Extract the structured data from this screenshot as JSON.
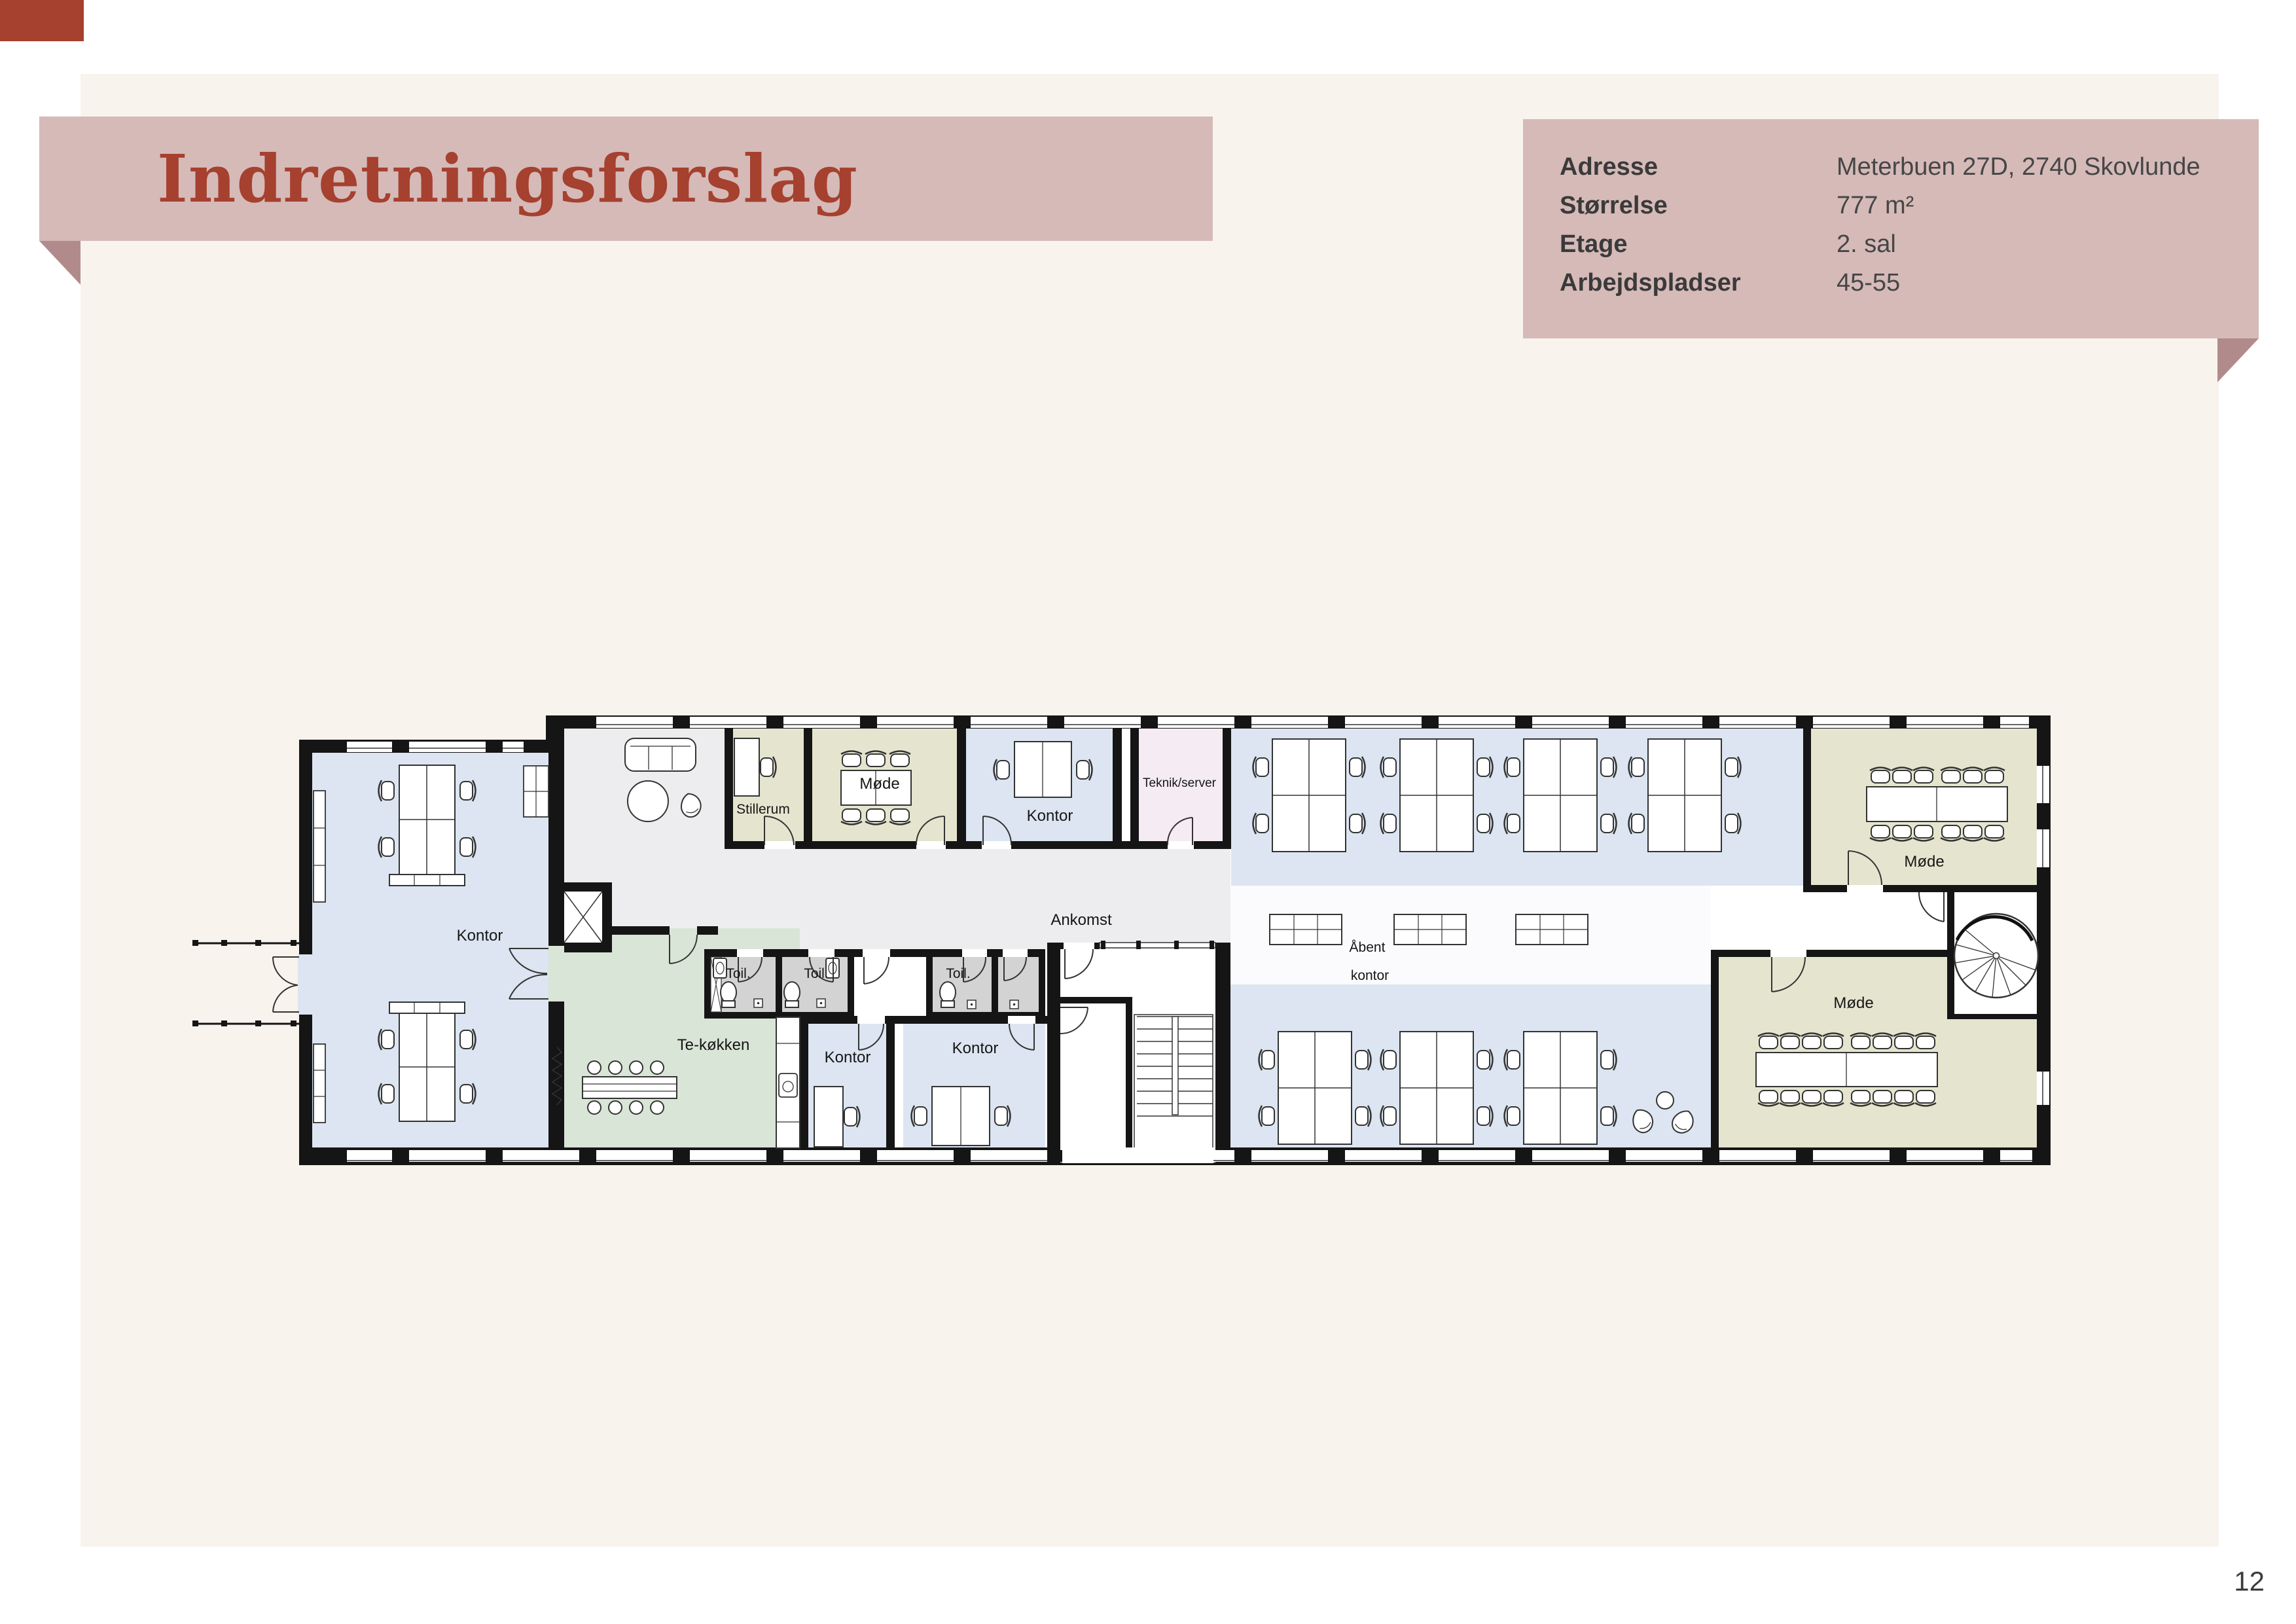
{
  "banner": {
    "title": "Indretningsforslag"
  },
  "info_box": {
    "rows": [
      {
        "label": "Adresse",
        "value": "Meterbuen 27D, 2740 Skovlunde"
      },
      {
        "label": "Størrelse",
        "value": "777 m²"
      },
      {
        "label": "Etage",
        "value": "2. sal"
      },
      {
        "label": "Arbejdspladser",
        "value": "45-55"
      }
    ]
  },
  "floor_plan": {
    "labels": {
      "kontor": "Kontor",
      "stillerum": "Stillerum",
      "mode": "Møde",
      "teknik": "Teknik/server",
      "ankomst": "Ankomst",
      "aabent_line1": "Åbent",
      "aabent_line2": "kontor",
      "tekokken": "Te-køkken",
      "toil": "Toil."
    }
  },
  "page": {
    "number": "12"
  },
  "colors": {
    "accent_red": "#a6402f",
    "banner_pink": "#d5bab8",
    "fold_pink": "#b18b8b",
    "cream": "#f9f3ed",
    "office_blue": "#dce5f1",
    "meeting_olive": "#e5e5cf",
    "kitchen_green": "#d9e5d6",
    "toilet_grey": "#d3d3d3",
    "tech_pink": "#f5ecf3",
    "corridor_grey": "#ededf0",
    "wall_black": "#151515"
  }
}
